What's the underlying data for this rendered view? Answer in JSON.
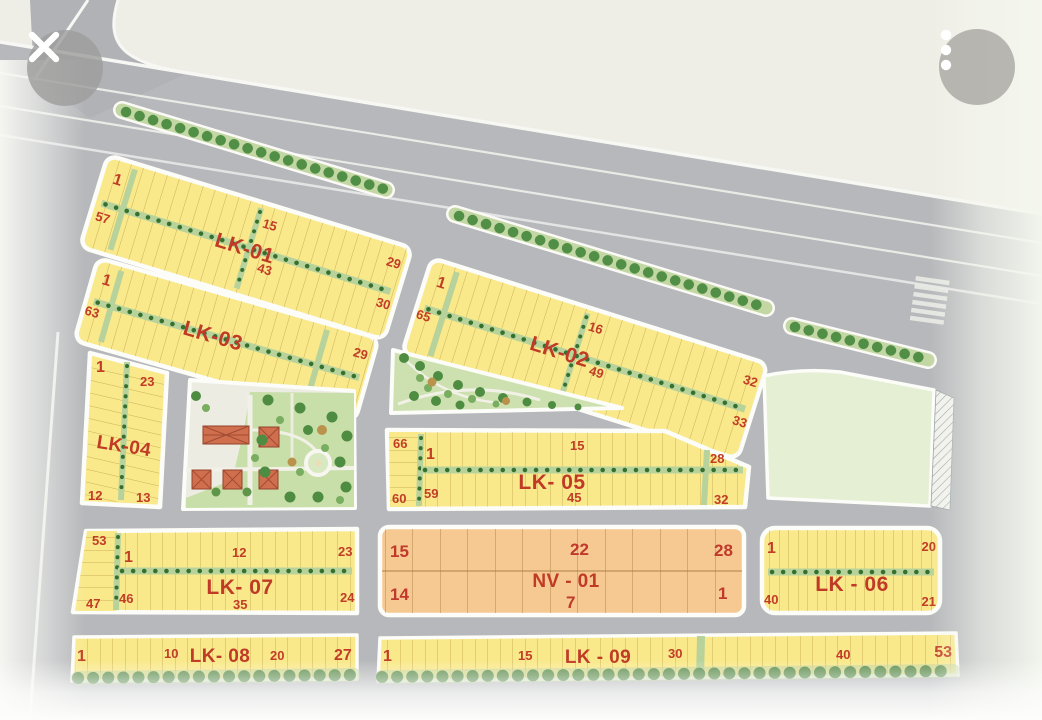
{
  "viewer": {
    "close_button": {
      "icon": "close-icon"
    },
    "menu_button": {
      "icon": "vertical-dots-icon",
      "dots": 3
    }
  },
  "map": {
    "type": "land-subdivision-master-plan",
    "blocks": {
      "lk01": {
        "label": "LK-01",
        "numbers": {
          "top_left": "1",
          "left": "57",
          "mid_top": "15",
          "mid_bottom": "43",
          "right_top": "29",
          "right_bottom": "30"
        }
      },
      "lk02": {
        "label": "LK-02",
        "numbers": {
          "top_left": "1",
          "left": "65",
          "mid_top": "16",
          "mid_bottom": "49",
          "right_top": "32",
          "right_bottom": "33"
        }
      },
      "lk03": {
        "label": "LK-03",
        "numbers": {
          "top_left": "1",
          "left": "63",
          "right_top": "29",
          "right_bottom": "36"
        }
      },
      "lk04": {
        "label": "LK-04",
        "numbers": {
          "top_left": "1",
          "top_right": "23",
          "bottom_left": "12",
          "bottom_right": "13"
        }
      },
      "lk05": {
        "label": "LK- 05",
        "numbers": {
          "far_left_top": "66",
          "left_top": "1",
          "mid_top": "15",
          "right_top": "28",
          "far_left_bottom": "60",
          "left_bottom": "59",
          "mid_bottom": "45",
          "right_bottom": "32"
        }
      },
      "lk06": {
        "label": "LK - 06",
        "numbers": {
          "top_left": "1",
          "top_right": "20",
          "bottom_left": "40",
          "bottom_right": "21"
        }
      },
      "lk07": {
        "label": "LK- 07",
        "numbers": {
          "far_left_top": "53",
          "left_top": "1",
          "mid_top": "12",
          "right_top": "23",
          "far_left_bottom": "47",
          "left_bottom": "46",
          "mid_bottom": "35",
          "right_bottom": "24"
        }
      },
      "lk08": {
        "label": "LK- 08",
        "numbers": {
          "left": "1",
          "mid_left": "10",
          "mid_right": "20",
          "right": "27"
        }
      },
      "lk09": {
        "label": "LK - 09",
        "numbers": {
          "left": "1",
          "mid_left": "15",
          "mid": "30",
          "mid_right": "40",
          "right": "53"
        }
      },
      "nv01": {
        "label": "NV - 01",
        "numbers": {
          "top_left": "15",
          "top_mid": "22",
          "top_right": "28",
          "bottom_left": "14",
          "bottom_mid": "7",
          "bottom_right": "1"
        }
      }
    },
    "colors": {
      "accent_red": "#c23d27",
      "plot_yellow": "#f9e98b",
      "block_orange": "#f6c892",
      "road_gray": "#b6b8bb",
      "green_strip": "#c3d7a4",
      "tree_green": "#4b8a41",
      "park_green": "#cfe2b3",
      "reserved_green": "#e4efd3",
      "background_beige": "#efeee6"
    }
  }
}
